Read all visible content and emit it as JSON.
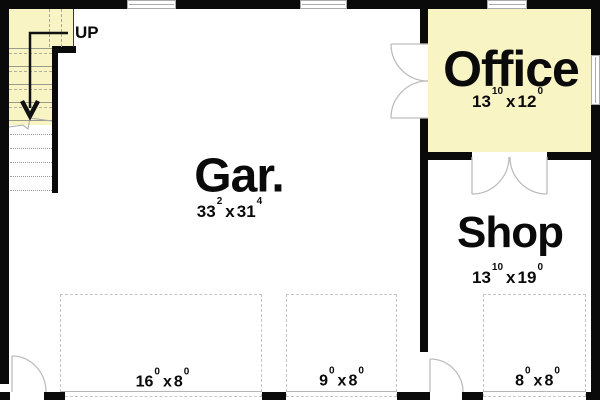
{
  "colors": {
    "room_highlight": "#F8F4C4",
    "wall": "#0A0A0A"
  },
  "sep": "x",
  "stairs": {
    "direction_label": "UP"
  },
  "rooms": {
    "garage": {
      "label": "Gar.",
      "dim": {
        "f1": "33",
        "i1": "2",
        "f2": "31",
        "i2": "4"
      }
    },
    "office": {
      "label": "Office",
      "dim": {
        "f1": "13",
        "i1": "10",
        "f2": "12",
        "i2": "0"
      }
    },
    "shop": {
      "label": "Shop",
      "dim": {
        "f1": "13",
        "i1": "10",
        "f2": "19",
        "i2": "0"
      }
    }
  },
  "overhead_doors": [
    {
      "dim": {
        "f1": "16",
        "i1": "0",
        "f2": "8",
        "i2": "0"
      }
    },
    {
      "dim": {
        "f1": "9",
        "i1": "0",
        "f2": "8",
        "i2": "0"
      }
    },
    {
      "dim": {
        "f1": "8",
        "i1": "0",
        "f2": "8",
        "i2": "0"
      }
    }
  ]
}
